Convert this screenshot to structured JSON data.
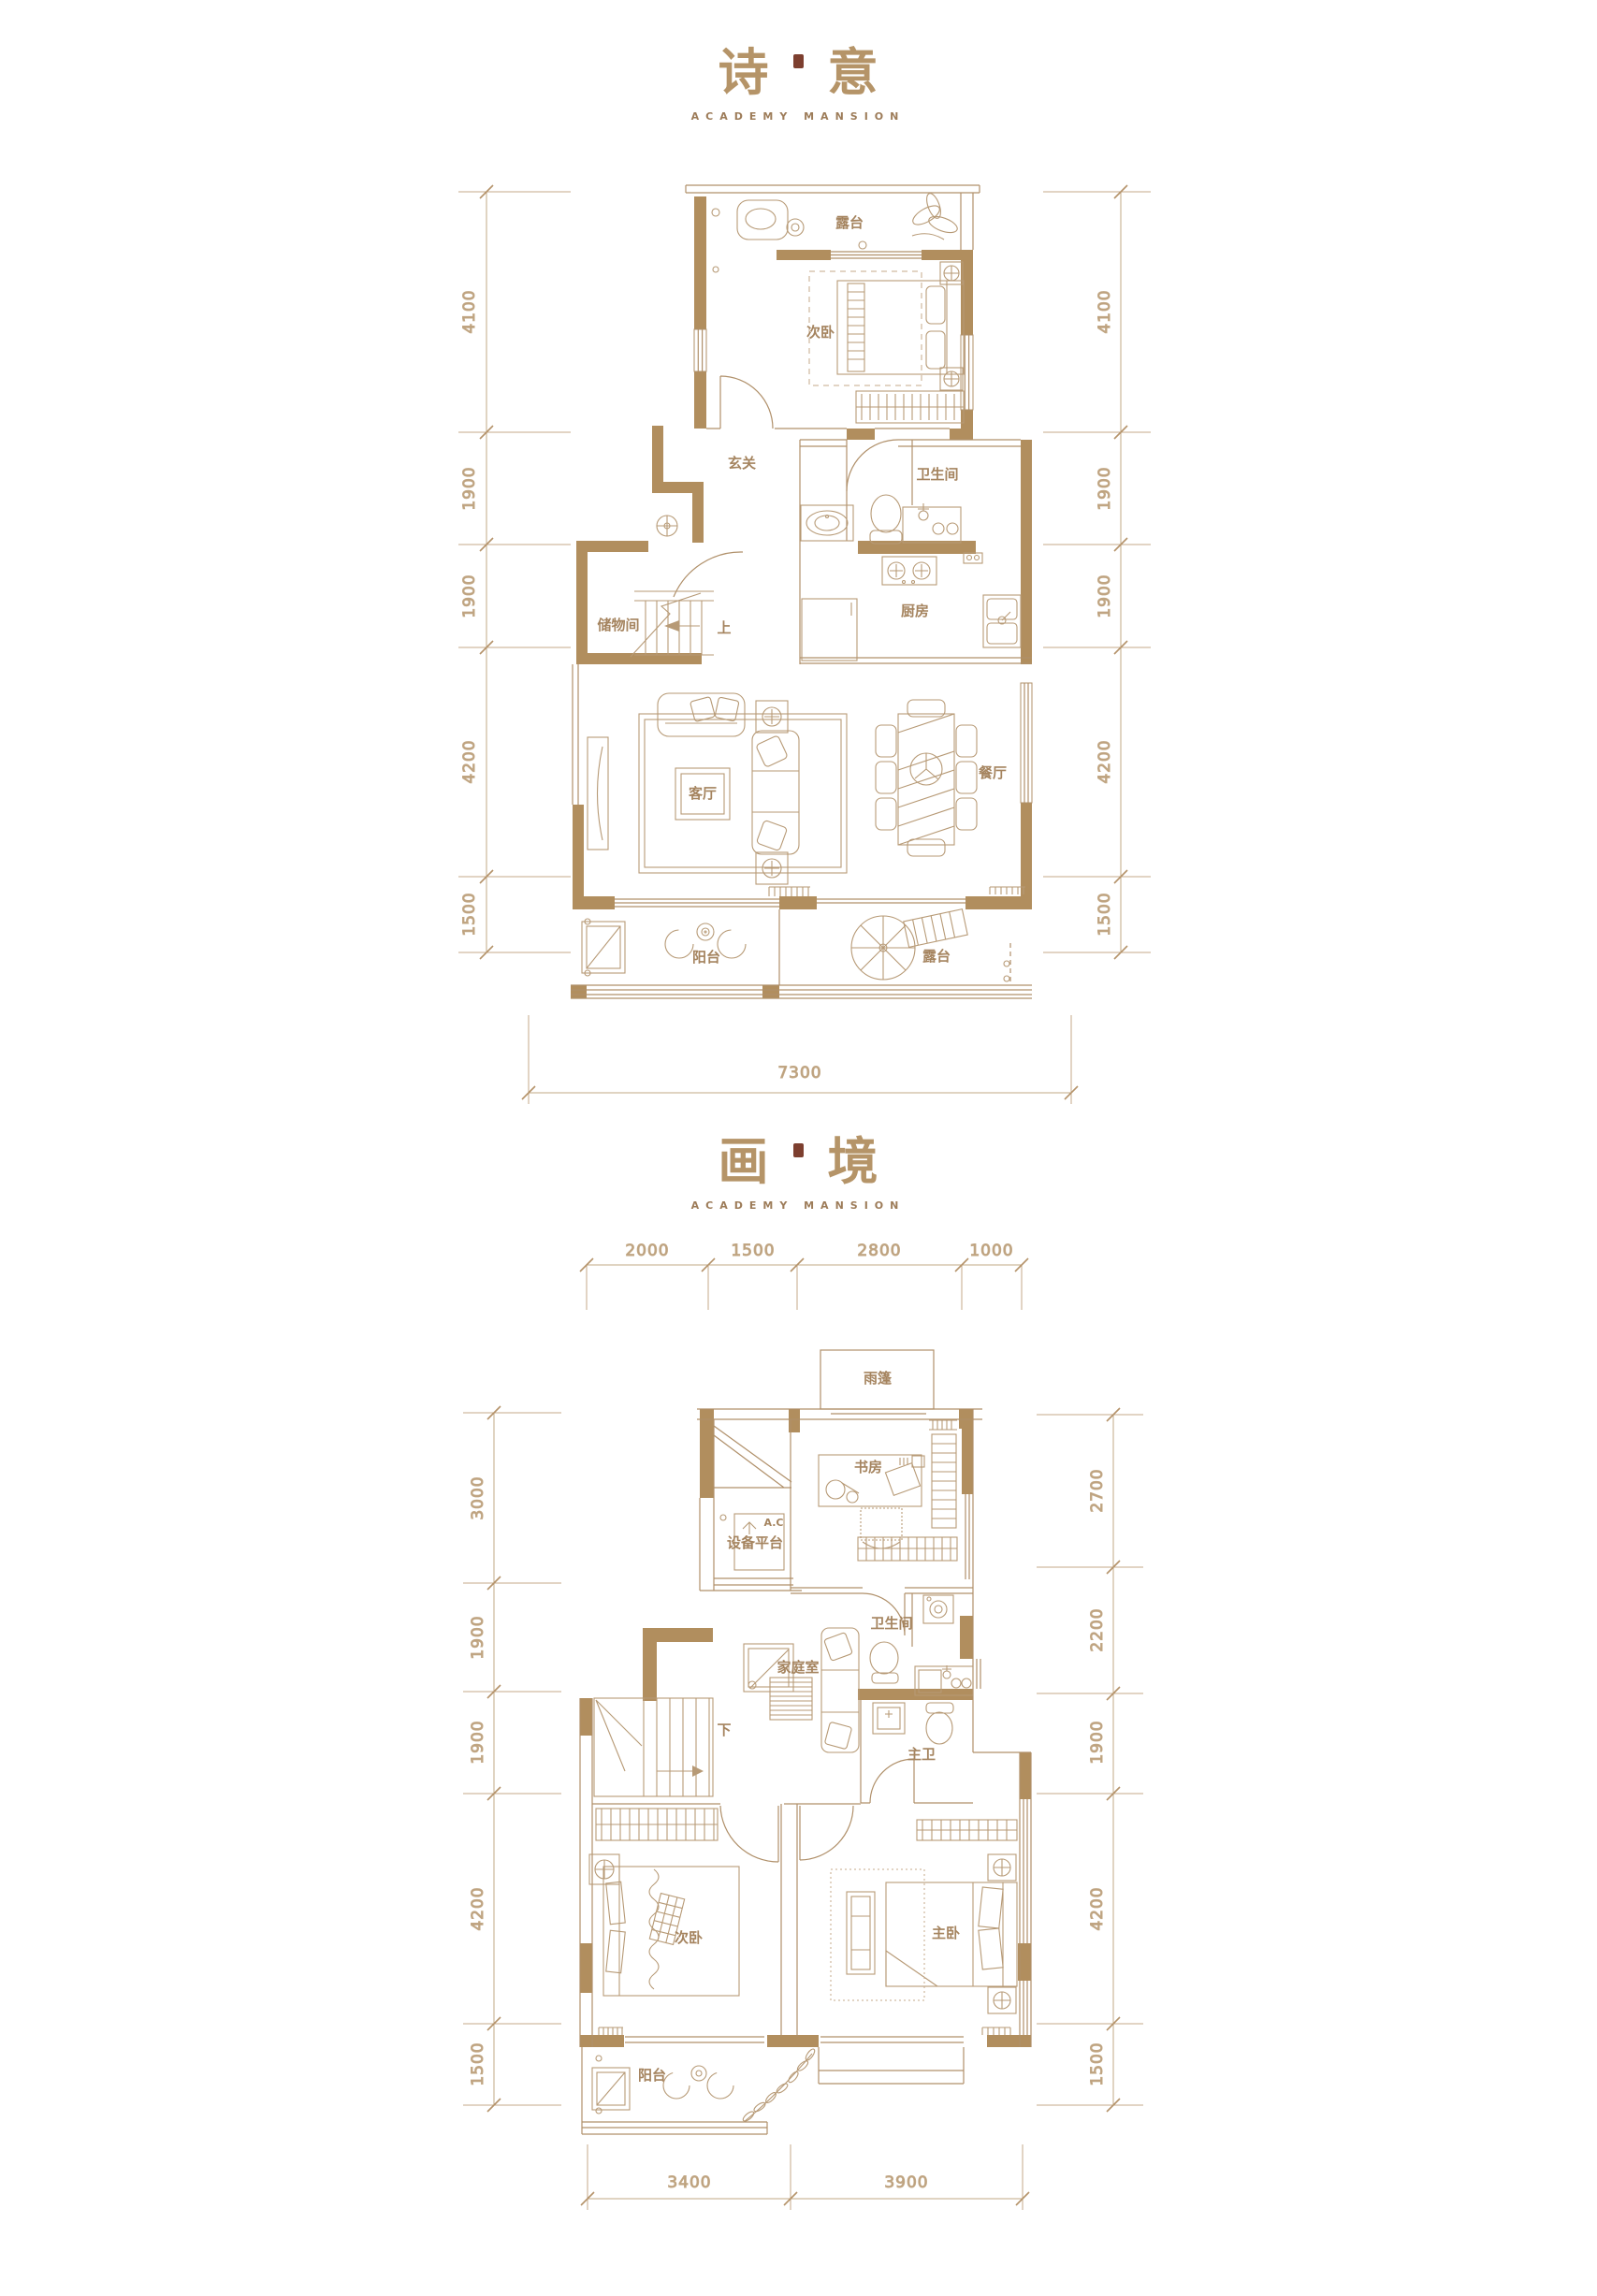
{
  "page": {
    "background": "#ffffff",
    "accent_color": "#b18e5e",
    "line_color": "#b0906a",
    "label_color": "#a5845f",
    "dim_color": "#bb9e7a",
    "title_color": "#b59468",
    "seal_color": "#7d3f2f"
  },
  "plan1": {
    "title_char1": "诗",
    "title_char2": "意",
    "subtitle": "ACADEMY MANSION",
    "rooms": {
      "terrace_top": "露台",
      "bedroom2": "次卧",
      "foyer": "玄关",
      "bathroom": "卫生间",
      "storage": "储物间",
      "stairs_dir": "上",
      "kitchen": "厨房",
      "living": "客厅",
      "dining": "餐厅",
      "balcony": "阳台",
      "terrace_bottom": "露台"
    },
    "dims_left": [
      "4100",
      "1900",
      "1900",
      "4200",
      "1500"
    ],
    "dims_right": [
      "4100",
      "1900",
      "1900",
      "4200",
      "1500"
    ],
    "dims_bottom": [
      "7300"
    ]
  },
  "plan2": {
    "title_char1": "画",
    "title_char2": "境",
    "subtitle": "ACADEMY MANSION",
    "rooms": {
      "canopy": "雨篷",
      "study": "书房",
      "equipment_platform": "设备平台",
      "ac": "A.C",
      "bathroom": "卫生间",
      "family": "家庭室",
      "master_bath": "主卫",
      "stairs_dir": "下",
      "bedroom2": "次卧",
      "master_bedroom": "主卧",
      "balcony": "阳台"
    },
    "dims_top": [
      "2000",
      "1500",
      "2800",
      "1000"
    ],
    "dims_left": [
      "3000",
      "1900",
      "1900",
      "4200",
      "1500"
    ],
    "dims_right": [
      "2700",
      "2200",
      "1900",
      "4200",
      "1500"
    ],
    "dims_bottom": [
      "3400",
      "3900"
    ]
  }
}
